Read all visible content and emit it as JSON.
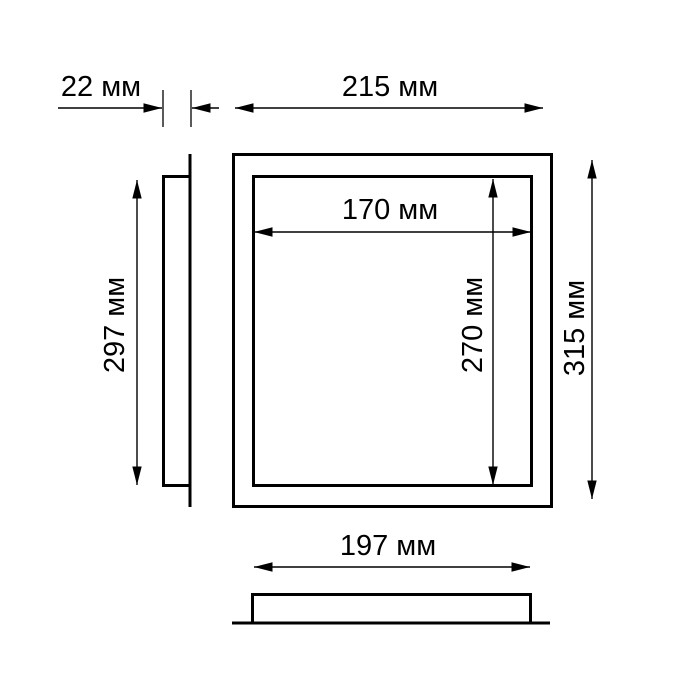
{
  "page": {
    "background_color": "#ffffff",
    "line_color": "#000000"
  },
  "drawing": {
    "kind": "panel-dimension-drawing",
    "unit": "мм",
    "labels": {
      "frame_depth": "22 мм",
      "outer_width": "215 мм",
      "inner_width": "170 мм",
      "inner_height": "270 мм",
      "side_height": "297 мм",
      "outer_height": "315 мм",
      "recess_width": "197 мм"
    },
    "values_mm": {
      "frame_depth": 22,
      "outer_width": 215,
      "inner_width": 170,
      "inner_height": 270,
      "side_height": 297,
      "outer_height": 315,
      "recess_width": 197
    }
  }
}
